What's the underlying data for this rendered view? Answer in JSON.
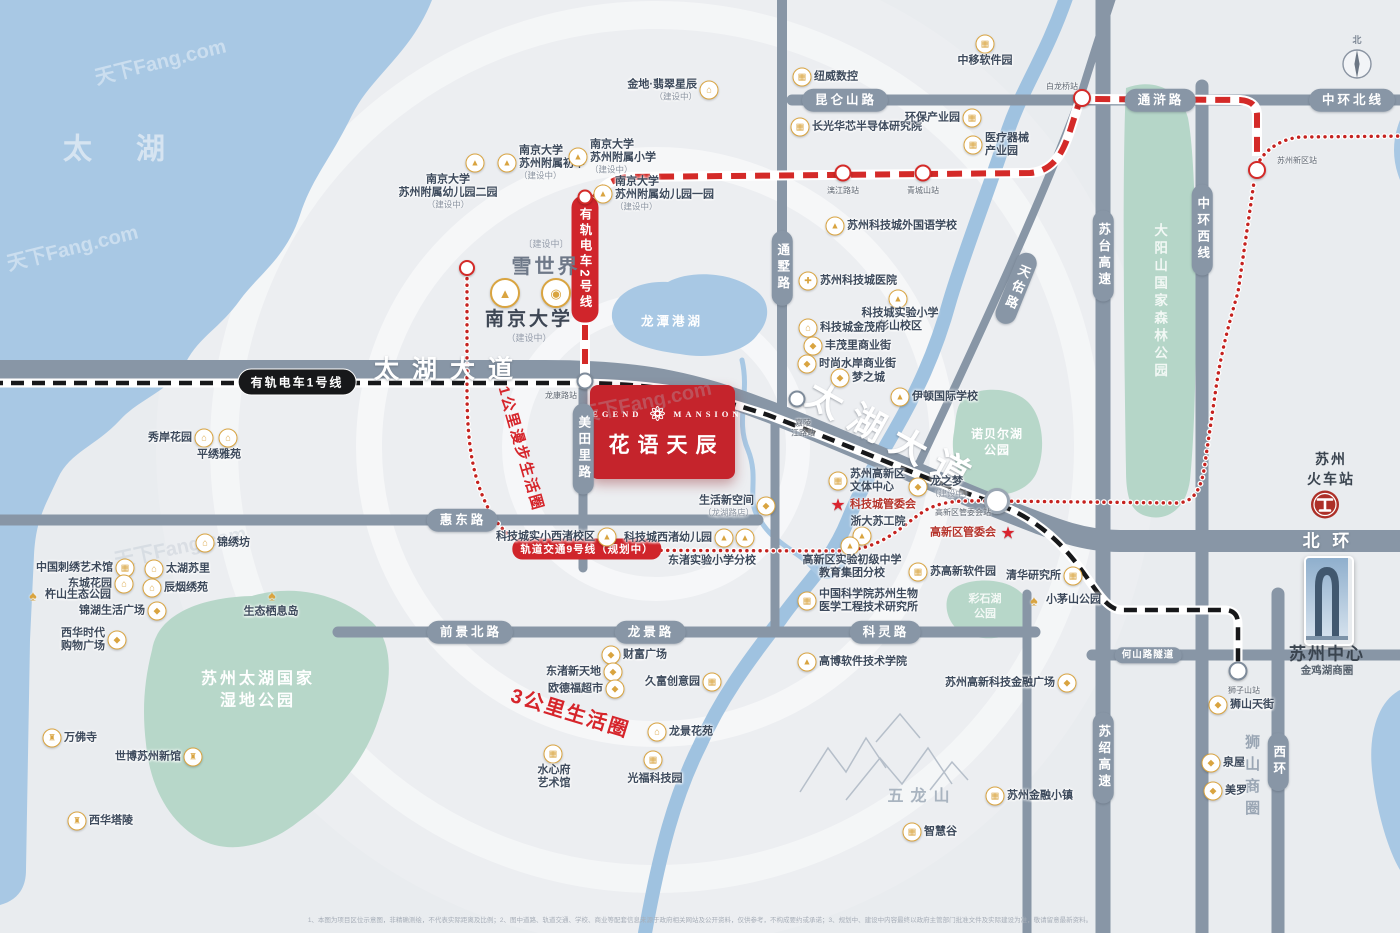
{
  "meta": {
    "watermark": "天下Fang.com",
    "disclaimer": "1、本图为项目区位示意图，非精确测绘，不代表实际距离及比例；2、图中道路、轨道交通、学校、商业等配套信息来源于政府相关网站及公开资料，仅供参考，不构成要约或承诺；3、规划中、建设中内容最终以政府主管部门批准文件及实际建设为准，敬请留意最新资料。"
  },
  "colors": {
    "water": "#a8c8e4",
    "park": "#b7d7c9",
    "road": "#8896a6",
    "accent_red": "#d0252b",
    "project_red": "#c5242c",
    "poi_gold": "#d9a440"
  },
  "icon_glyphs": {
    "house": "⌂",
    "building": "▦",
    "school": "▲",
    "shop": "◆",
    "hospital": "✚",
    "temple": "♜",
    "tree": "♠",
    "emblem": "◉",
    "star": "★"
  },
  "project": {
    "en_left": "LEGEND",
    "en_right": "MANSION",
    "name": "花语天辰"
  },
  "landmarks": {
    "xueshijie": {
      "sub": "〔建设中〕",
      "name": "雪世界"
    },
    "nanda": {
      "name": "南京大学",
      "sub": "（建设中）"
    },
    "suzhou_center": {
      "name": "苏州中心",
      "sub": "金鸡湖商圈"
    },
    "railway": {
      "name": "苏州\n火车站"
    },
    "compass_north": "北"
  },
  "transit": {
    "tram1": {
      "label": "有轨电车1号线"
    },
    "tram2": {
      "label": "有轨电车2号线"
    },
    "line9": {
      "label": "轨道交通9号线（规划中）"
    }
  },
  "road_capsules": [
    {
      "t": "昆仑山路",
      "x": 845,
      "y": 100,
      "o": "h"
    },
    {
      "t": "通浒路",
      "x": 1160,
      "y": 100,
      "o": "h"
    },
    {
      "t": "中环北线",
      "x": 1352,
      "y": 100,
      "o": "h"
    },
    {
      "t": "惠东路",
      "x": 462,
      "y": 520,
      "o": "h"
    },
    {
      "t": "前景北路",
      "x": 470,
      "y": 632,
      "o": "h"
    },
    {
      "t": "龙景路",
      "x": 650,
      "y": 632,
      "o": "h"
    },
    {
      "t": "科灵路",
      "x": 885,
      "y": 632,
      "o": "h"
    },
    {
      "t": "何山路隧道",
      "x": 1148,
      "y": 655,
      "o": "h",
      "small": true
    },
    {
      "t": "通墅路",
      "x": 782,
      "y": 268,
      "o": "v"
    },
    {
      "t": "美田里路",
      "x": 583,
      "y": 449,
      "o": "v"
    },
    {
      "t": "苏台高速",
      "x": 1103,
      "y": 256,
      "o": "v"
    },
    {
      "t": "中环西线",
      "x": 1202,
      "y": 230,
      "o": "v"
    },
    {
      "t": "苏绍高速",
      "x": 1103,
      "y": 758,
      "o": "v"
    },
    {
      "t": "西环",
      "x": 1278,
      "y": 762,
      "o": "v"
    },
    {
      "t": "天佑路",
      "x": 1016,
      "y": 288,
      "o": "v",
      "rot": 22
    }
  ],
  "road_names": [
    {
      "t": "太湖大道",
      "x": 450,
      "y": 370,
      "size": 25,
      "ls": 13,
      "rot": 0
    },
    {
      "t": "太湖大道",
      "x": 893,
      "y": 438,
      "size": 36,
      "ls": 12,
      "rot": 29
    },
    {
      "t": "北 环",
      "x": 1328,
      "y": 541,
      "size": 17,
      "ls": 4,
      "rot": 0
    }
  ],
  "area_labels": [
    {
      "t": "太 湖",
      "x": 123,
      "y": 150,
      "size": 29,
      "color": "#d9e6f2",
      "ls": 18,
      "op": 0.95
    },
    {
      "t": "龙潭港湖",
      "x": 672,
      "y": 322,
      "size": 12.5,
      "color": "#ffffff",
      "ls": 3
    },
    {
      "t": "苏州太湖国家\n湿地公园",
      "x": 258,
      "y": 690,
      "size": 16,
      "color": "#ffffff",
      "ls": 3
    },
    {
      "t": "大阳山国家森林公园",
      "x": 1159,
      "y": 302,
      "size": 13.5,
      "color": "#f2f8f5",
      "ls": 4,
      "vert": true
    },
    {
      "t": "诺贝尔湖\n公园",
      "x": 997,
      "y": 442,
      "size": 12,
      "color": "#ffffff",
      "ls": 1
    },
    {
      "t": "彩石湖\n公园",
      "x": 985,
      "y": 607,
      "size": 11,
      "color": "#ffffff",
      "op": 0.85
    },
    {
      "t": "五龙山",
      "x": 922,
      "y": 797,
      "size": 16,
      "color": "#a9b4c0",
      "ls": 7
    },
    {
      "t": "狮山商圈",
      "x": 1251,
      "y": 778,
      "size": 15,
      "color": "#9aa6b4",
      "ls": 7,
      "vert": true
    },
    {
      "t": "1公里漫步生活圈",
      "x": 520,
      "y": 449,
      "size": 15,
      "color": "#d6252b",
      "rot": 74,
      "ls": 2
    },
    {
      "t": "3公里生活圈",
      "x": 570,
      "y": 714,
      "size": 20,
      "color": "#d6252b",
      "rot": 17,
      "ls": 2
    }
  ],
  "stations": [
    {
      "n": "龙康路站",
      "cx": 585,
      "cy": 381,
      "lx": 561,
      "ly": 396,
      "ring": "dark",
      "size": 13
    },
    {
      "n": "嘉陵\n江路站",
      "cx": 797,
      "cy": 399,
      "lx": 803,
      "ly": 428,
      "ring": "dark",
      "size": 13
    },
    {
      "n": "高新区管委会站",
      "cx": 997,
      "cy": 501,
      "lx": 963,
      "ly": 513,
      "ring": "big",
      "size": 20
    },
    {
      "n": "狮子山站",
      "cx": 1238,
      "cy": 671,
      "lx": 1244,
      "ly": 691,
      "ring": "dark",
      "size": 15
    },
    {
      "n": "白龙桥站",
      "cx": 1082,
      "cy": 98,
      "lx": 1062,
      "ly": 87,
      "ring": "red",
      "size": 14
    },
    {
      "n": "漓江路站",
      "cx": 843,
      "cy": 173,
      "lx": 843,
      "ly": 191,
      "ring": "red",
      "size": 13
    },
    {
      "n": "青城山站",
      "cx": 923,
      "cy": 173,
      "lx": 923,
      "ly": 191,
      "ring": "red",
      "size": 13
    },
    {
      "n": "苏州新区站",
      "cx": 1257,
      "cy": 170,
      "lx": 1297,
      "ly": 161,
      "ring": "red",
      "size": 14
    },
    {
      "n": "",
      "cx": 585,
      "cy": 197,
      "ring": "red",
      "size": 11
    },
    {
      "n": "",
      "cx": 467,
      "cy": 268,
      "ring": "red",
      "size": 12
    }
  ],
  "pois": [
    {
      "n": "金地·翡翠星辰",
      "sub": "（建设中）",
      "icon": "house",
      "x": 709,
      "y": 90,
      "side": "l"
    },
    {
      "n": "纽威数控",
      "icon": "building",
      "x": 802,
      "y": 77,
      "side": "r"
    },
    {
      "n": "中移软件园",
      "icon": "building",
      "x": 985,
      "y": 44,
      "lx": 985,
      "ly": 61
    },
    {
      "n": "长光华芯半导体研究院",
      "icon": "building",
      "x": 800,
      "y": 127,
      "side": "r"
    },
    {
      "n": "环保产业园",
      "icon": "building",
      "x": 972,
      "y": 118,
      "side": "l"
    },
    {
      "n": "医疗器械\n产业园",
      "icon": "building",
      "x": 973,
      "y": 145,
      "side": "r"
    },
    {
      "n": "南京大学\n苏州附属幼儿园二园",
      "sub": "（建设中）",
      "icon": "school",
      "x": 475,
      "y": 163,
      "lx": 448,
      "ly": 192
    },
    {
      "n": "南京大学\n苏州附属初中",
      "sub": "（建设中）",
      "icon": "school",
      "x": 507,
      "y": 163,
      "side": "r"
    },
    {
      "n": "南京大学\n苏州附属小学",
      "sub": "（建设中）",
      "icon": "school",
      "x": 578,
      "y": 157,
      "side": "r"
    },
    {
      "n": "南京大学\n苏州附属幼儿园一园",
      "sub": "（建设中）",
      "icon": "school",
      "x": 603,
      "y": 194,
      "side": "r"
    },
    {
      "n": "苏州科技城外国语学校",
      "icon": "school",
      "x": 835,
      "y": 226,
      "side": "r"
    },
    {
      "n": "苏州科技城医院",
      "icon": "hospital",
      "x": 808,
      "y": 281,
      "side": "r"
    },
    {
      "n": "科技城实验小学\n彭山校区",
      "icon": "school",
      "x": 898,
      "y": 299,
      "lx": 900,
      "ly": 320
    },
    {
      "n": "科技城金茂府",
      "icon": "house",
      "x": 808,
      "y": 328,
      "side": "r"
    },
    {
      "n": "丰茂里商业街",
      "icon": "shop",
      "x": 813,
      "y": 346,
      "side": "r"
    },
    {
      "n": "时尚水岸商业街",
      "icon": "shop",
      "x": 807,
      "y": 364,
      "side": "r"
    },
    {
      "n": "梦之城",
      "icon": "shop",
      "x": 840,
      "y": 378,
      "side": "r"
    },
    {
      "n": "伊顿国际学校",
      "icon": "school",
      "x": 900,
      "y": 397,
      "side": "r"
    },
    {
      "n": "生活新空间",
      "sub": "（龙湖路店）",
      "icon": "shop",
      "x": 766,
      "y": 506,
      "side": "l"
    },
    {
      "n": "苏州高新区\n文体中心",
      "icon": "building",
      "x": 838,
      "y": 481,
      "side": "r"
    },
    {
      "n": "龙之梦",
      "sub": "（建设中）",
      "icon": "shop",
      "x": 918,
      "y": 487,
      "side": "r"
    },
    {
      "n": "科技城管委会",
      "star": true,
      "x": 838,
      "y": 505,
      "side": "r",
      "red": true
    },
    {
      "n": "浙大苏工院",
      "icon": "school",
      "x": 862,
      "y": 536,
      "lx": 878,
      "ly": 522
    },
    {
      "n": "高新区管委会",
      "star": true,
      "x": 1008,
      "y": 533,
      "side": "l",
      "red": true
    },
    {
      "n": "苏高新软件园",
      "icon": "building",
      "x": 918,
      "y": 572,
      "side": "r"
    },
    {
      "n": "清华研究所",
      "icon": "building",
      "x": 1073,
      "y": 576,
      "side": "l"
    },
    {
      "n": "小茅山公园",
      "icon": "tree",
      "x": 1034,
      "y": 600,
      "side": "r"
    },
    {
      "n": "中国科学院苏州生物\n医学工程技术研究所",
      "icon": "building",
      "x": 807,
      "y": 601,
      "side": "r"
    },
    {
      "n": "高博软件技术学院",
      "icon": "school",
      "x": 807,
      "y": 662,
      "side": "r"
    },
    {
      "n": "苏州高新科技金融广场",
      "icon": "shop",
      "x": 1067,
      "y": 683,
      "side": "l"
    },
    {
      "n": "狮山天街",
      "icon": "shop",
      "x": 1218,
      "y": 705,
      "side": "r"
    },
    {
      "n": "泉屋",
      "icon": "shop",
      "x": 1211,
      "y": 763,
      "side": "r"
    },
    {
      "n": "美罗",
      "icon": "shop",
      "x": 1213,
      "y": 791,
      "side": "r"
    },
    {
      "n": "苏州金融小镇",
      "icon": "building",
      "x": 995,
      "y": 796,
      "side": "r"
    },
    {
      "n": "智慧谷",
      "icon": "building",
      "x": 912,
      "y": 832,
      "side": "r"
    },
    {
      "n": "财富广场",
      "icon": "shop",
      "x": 611,
      "y": 655,
      "side": "r"
    },
    {
      "n": "东渚新天地",
      "icon": "shop",
      "x": 613,
      "y": 672,
      "side": "l"
    },
    {
      "n": "欧德福超市",
      "icon": "shop",
      "x": 615,
      "y": 689,
      "side": "l"
    },
    {
      "n": "久富创意园",
      "icon": "building",
      "x": 712,
      "y": 682,
      "side": "l"
    },
    {
      "n": "龙景花苑",
      "icon": "house",
      "x": 657,
      "y": 732,
      "side": "r"
    },
    {
      "n": "水心府\n艺术馆",
      "icon": "building",
      "x": 553,
      "y": 754,
      "lx": 554,
      "ly": 777
    },
    {
      "n": "光福科技园",
      "icon": "building",
      "x": 653,
      "y": 760,
      "lx": 655,
      "ly": 779
    },
    {
      "n": "科技城实小西渚校区",
      "icon": "school",
      "x": 607,
      "y": 537,
      "side": "l"
    },
    {
      "n": "科技城西渚幼儿园",
      "icon": "school",
      "x": 724,
      "y": 538,
      "side": "l"
    },
    {
      "n": "东渚实验小学分校",
      "lx": 712,
      "ly": 561
    },
    {
      "n": "高新区实验初级中学\n教育集团分校",
      "icon": "school",
      "x": 850,
      "y": 546,
      "lx": 852,
      "ly": 567
    },
    {
      "n": "锦绣坊",
      "icon": "house",
      "x": 205,
      "y": 543,
      "side": "r"
    },
    {
      "n": "太湖苏里",
      "icon": "house",
      "x": 154,
      "y": 569,
      "side": "r"
    },
    {
      "n": "中国刺绣艺术馆",
      "icon": "building",
      "x": 125,
      "y": 568,
      "side": "l"
    },
    {
      "n": "东城花园",
      "icon": "house",
      "x": 124,
      "y": 584,
      "side": "l"
    },
    {
      "n": "辰烟绣苑",
      "icon": "house",
      "x": 152,
      "y": 588,
      "side": "r"
    },
    {
      "n": "杵山生态公园",
      "icon": "tree",
      "x": 33,
      "y": 595,
      "side": "r"
    },
    {
      "n": "锦湖生活广场",
      "icon": "shop",
      "x": 157,
      "y": 611,
      "side": "l"
    },
    {
      "n": "西华时代\n购物广场",
      "icon": "shop",
      "x": 117,
      "y": 640,
      "side": "l"
    },
    {
      "n": "生态栖息岛",
      "icon": "tree",
      "x": 272,
      "y": 595,
      "lx": 271,
      "ly": 612
    },
    {
      "n": "万佛寺",
      "icon": "temple",
      "x": 52,
      "y": 738,
      "side": "r"
    },
    {
      "n": "世博苏州新馆",
      "icon": "temple",
      "x": 193,
      "y": 757,
      "side": "l"
    },
    {
      "n": "西华塔陵",
      "icon": "temple",
      "x": 77,
      "y": 821,
      "side": "r"
    },
    {
      "n": "秀岸花园",
      "icon": "house",
      "x": 204,
      "y": 438,
      "side": "l"
    },
    {
      "n": "平绣雅苑",
      "lx": 219,
      "ly": 455
    }
  ],
  "extra_icons": [
    {
      "icon": "house",
      "x": 228,
      "y": 438
    },
    {
      "icon": "school",
      "x": 745,
      "y": 538
    }
  ],
  "watermarks": [
    {
      "x": 160,
      "y": 60,
      "rot": -14,
      "light": true
    },
    {
      "x": 72,
      "y": 246,
      "rot": -14,
      "light": true
    },
    {
      "x": 645,
      "y": 400,
      "rot": -12,
      "light": false
    },
    {
      "x": 180,
      "y": 545,
      "rot": -12,
      "light": false
    }
  ]
}
